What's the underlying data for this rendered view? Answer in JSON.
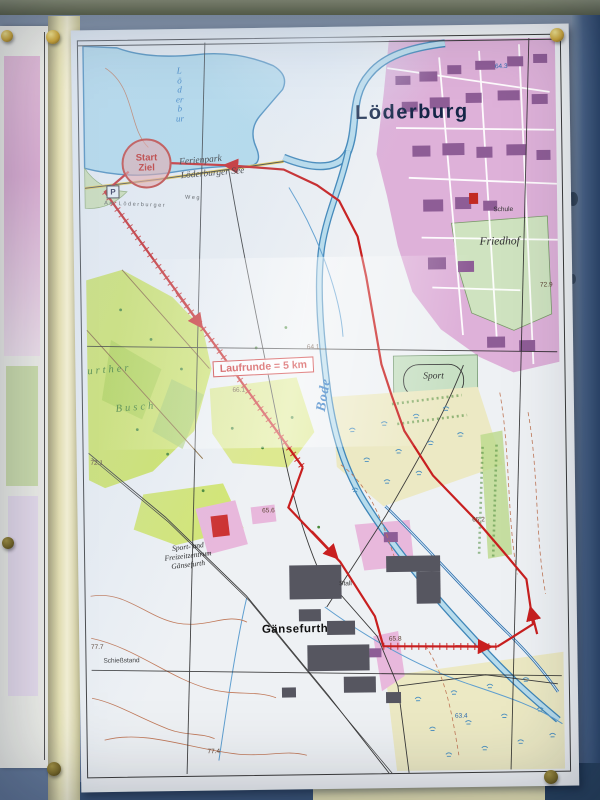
{
  "scene": {
    "type": "photo-of-outdoor-notice-board-with-map",
    "colors": {
      "board_blue_gray": "#76889f",
      "frame_cream": "#e7e3b6",
      "top_rail_olive": "#5c634c",
      "sheet_paper": "#eef1f4",
      "water": "#b3dcec",
      "water_edge": "#3f86b8",
      "urban_pink": "#dcabd6",
      "building_purple": "#8e5d96",
      "forest_green": "#cfe468",
      "meadow_green": "#cfe3c0",
      "field_pale": "#ece9c4",
      "route_red": "#c81f1f",
      "contour_brown": "#c07858",
      "pin_brass": "#cfa93c"
    },
    "pins": [
      "push-pin",
      "push-pin",
      "push-pin",
      "push-pin",
      "push-pin"
    ]
  },
  "map": {
    "title": "Löderburg",
    "route_badge": "Laufrunde = 5 km",
    "start": {
      "top": "Start",
      "bottom": "Ziel"
    },
    "parking_symbol": "P",
    "labels": [
      {
        "id": "ferienpark",
        "t": "Ferienpark",
        "x": 122,
        "y": 123,
        "c": "place-italic",
        "r": -4
      },
      {
        "id": "loederburger-see",
        "t": "Löderburger See",
        "x": 134,
        "y": 136,
        "c": "place-italic",
        "r": -4
      },
      {
        "id": "lake-name-vertical",
        "t": "Löderbur",
        "x": 102,
        "y": 56,
        "c": "water-vert",
        "r": 0
      },
      {
        "id": "bode-river",
        "t": "Bode",
        "x": 243,
        "y": 358,
        "c": "water-name",
        "r": -80
      },
      {
        "id": "sport-field",
        "t": "Sport",
        "x": 352,
        "y": 342,
        "c": "place-italic",
        "r": 0
      },
      {
        "id": "friedhof",
        "t": "Friedhof",
        "x": 420,
        "y": 207,
        "c": "place-italic-lg",
        "r": 0
      },
      {
        "id": "schule",
        "t": "Schule",
        "x": 424,
        "y": 176,
        "c": "tiny",
        "r": 0
      },
      {
        "id": "stall",
        "t": "Stall",
        "x": 261,
        "y": 548,
        "c": "tiny",
        "r": 0
      },
      {
        "id": "gaensefurth",
        "t": "Gänsefurth",
        "x": 210,
        "y": 592,
        "c": "bold-place",
        "r": 0
      },
      {
        "id": "fz-1",
        "t": "Sport- und",
        "x": 104,
        "y": 508,
        "c": "tiny-it",
        "r": -6
      },
      {
        "id": "fz-2",
        "t": "Freizeitzentrum",
        "x": 104,
        "y": 517,
        "c": "tiny-it",
        "r": -6
      },
      {
        "id": "fz-3",
        "t": "Gänsefurth",
        "x": 104,
        "y": 526,
        "c": "tiny-it",
        "r": -6
      },
      {
        "id": "busch-1",
        "t": "urther",
        "x": 28,
        "y": 330,
        "c": "green-name",
        "r": -4
      },
      {
        "id": "busch-2",
        "t": "Busch",
        "x": 54,
        "y": 368,
        "c": "green-name",
        "r": -4
      },
      {
        "id": "schiessstand",
        "t": "Schießstand",
        "x": 36,
        "y": 622,
        "c": "tiny",
        "r": 0
      },
      {
        "id": "street-am-loederburger",
        "t": "Am Löderburger",
        "x": 56,
        "y": 166,
        "c": "street",
        "r": 3
      },
      {
        "id": "street-weg",
        "t": "Weg",
        "x": 114,
        "y": 160,
        "c": "street",
        "r": 3
      },
      {
        "id": "elev-64-3",
        "t": "64.3",
        "x": 424,
        "y": 33,
        "c": "elev-blue",
        "r": 0
      },
      {
        "id": "elev-64-1",
        "t": "64.1",
        "x": 232,
        "y": 311,
        "c": "elev",
        "r": 0
      },
      {
        "id": "elev-66-1",
        "t": "66.1",
        "x": 157,
        "y": 353,
        "c": "elev",
        "r": 0
      },
      {
        "id": "elev-72-9",
        "t": "72.9",
        "x": 466,
        "y": 252,
        "c": "elev",
        "r": 0
      },
      {
        "id": "elev-72-1",
        "t": "72.1",
        "x": 14,
        "y": 424,
        "c": "elev",
        "r": 0
      },
      {
        "id": "elev-65-6",
        "t": "65.6",
        "x": 185,
        "y": 474,
        "c": "elev",
        "r": 0
      },
      {
        "id": "elev-65-8",
        "t": "65.8",
        "x": 310,
        "y": 604,
        "c": "elev",
        "r": 0
      },
      {
        "id": "elev-65-2",
        "t": "65.2",
        "x": 395,
        "y": 486,
        "c": "elev",
        "r": 0
      },
      {
        "id": "elev-77-7",
        "t": "77.7",
        "x": 12,
        "y": 608,
        "c": "elev",
        "r": 0
      },
      {
        "id": "elev-63-4",
        "t": "63.4",
        "x": 375,
        "y": 682,
        "c": "elev-blue",
        "r": 0
      },
      {
        "id": "elev-77-4",
        "t": "77.4",
        "x": 127,
        "y": 714,
        "c": "elev",
        "r": 0
      }
    ]
  }
}
